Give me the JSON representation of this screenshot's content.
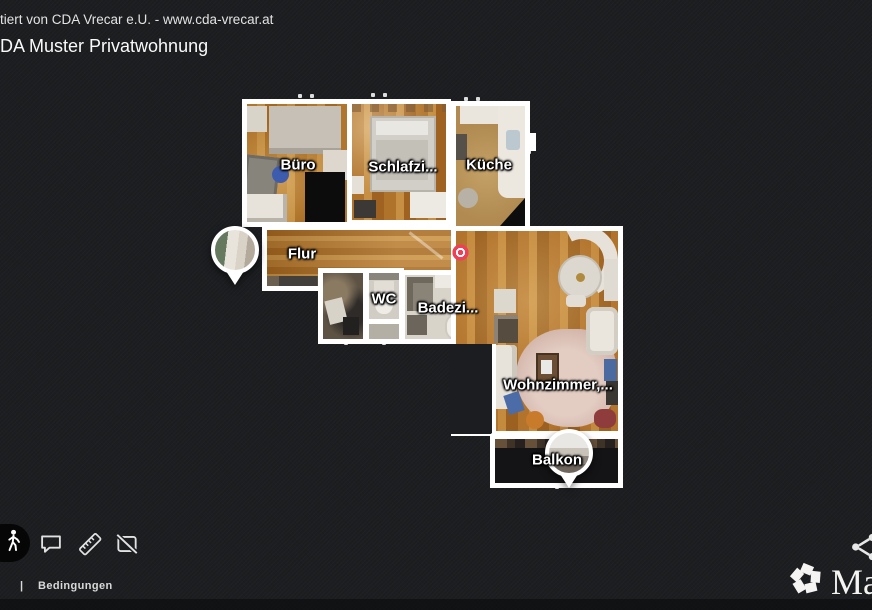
{
  "header": {
    "presented_by": "tiert von CDA Vrecar e.U. - www.cda-vrecar.at",
    "title": "DA Muster Privatwohnung"
  },
  "floorplan": {
    "rooms": [
      {
        "id": "buero",
        "label": "Büro"
      },
      {
        "id": "schlafzimmer",
        "label": "Schlafzi..."
      },
      {
        "id": "kueche",
        "label": "Küche"
      },
      {
        "id": "flur",
        "label": "Flur"
      },
      {
        "id": "wc",
        "label": "WC"
      },
      {
        "id": "badezimmer",
        "label": "Badezi..."
      },
      {
        "id": "wohnzimmer",
        "label": "Wohnzimmer,..."
      },
      {
        "id": "balkon",
        "label": "Balkon"
      }
    ],
    "markers": [
      {
        "name": "flur-photo-pin"
      },
      {
        "name": "balkon-photo-pin"
      },
      {
        "name": "current-position-target",
        "color": "#ee4056"
      }
    ],
    "wall_color": "#ffffff"
  },
  "toolbar": {
    "icons": [
      {
        "name": "walk-mode"
      },
      {
        "name": "comments"
      },
      {
        "name": "measure"
      },
      {
        "name": "pano-views-off"
      }
    ]
  },
  "footer": {
    "separator": "|",
    "terms": "Bedingungen"
  },
  "branding": {
    "logo_text": "Ma",
    "share": "share"
  },
  "colors": {
    "background": "#1b1d20",
    "accent_red": "#ee4056",
    "label": "#ffffff"
  }
}
